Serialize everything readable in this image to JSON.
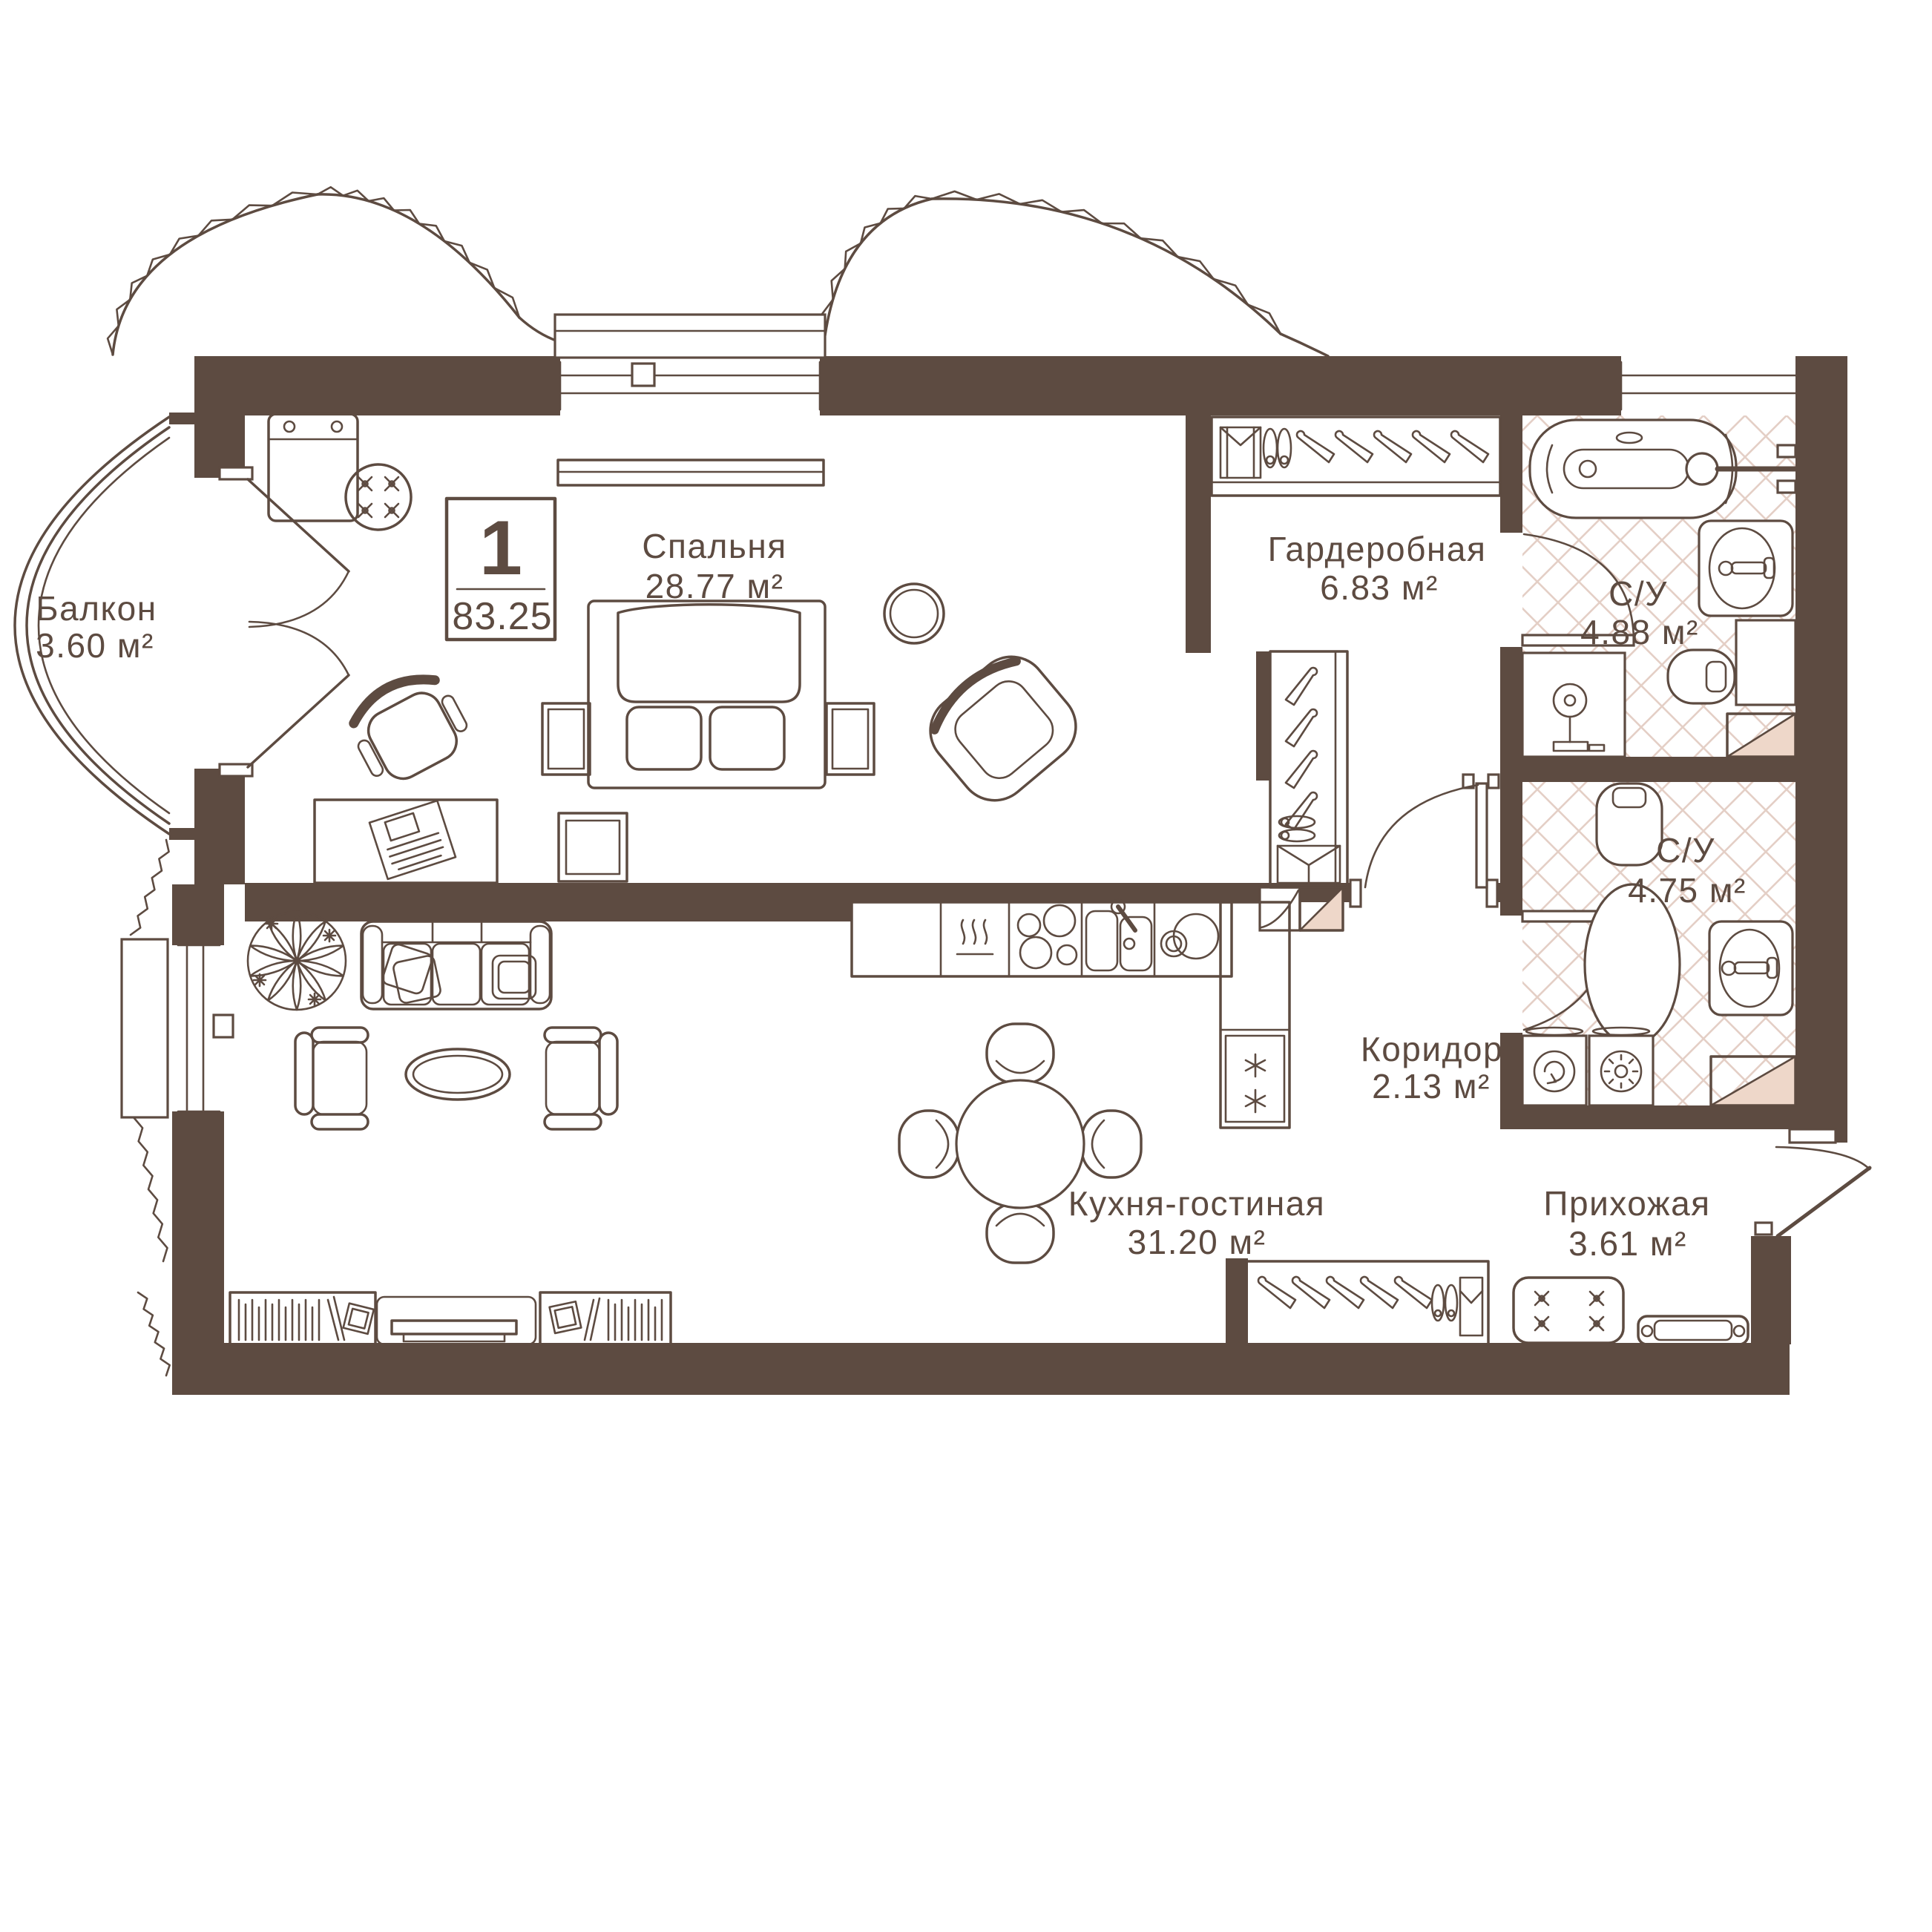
{
  "unit": {
    "rooms_count": "1",
    "total_area": "83.25"
  },
  "rooms": {
    "balcony": {
      "name": "Балкон",
      "area": "3.60 м²"
    },
    "bedroom": {
      "name": "Спальня",
      "area": "28.77 м²"
    },
    "wardrobe": {
      "name": "Гардеробная",
      "area": "6.83 м²"
    },
    "bathroom_1": {
      "name": "С/У",
      "area": "4.88 м²"
    },
    "bathroom_2": {
      "name": "С/У",
      "area": "4.75 м²"
    },
    "corridor": {
      "name": "Коридор",
      "area": "2.13 м²"
    },
    "kitchen_living": {
      "name": "Кухня-гостиная",
      "area": "31.20 м²"
    },
    "hallway": {
      "name": "Прихожая",
      "area": "3.61 м²"
    }
  },
  "colors": {
    "wall": "#5d4b41",
    "line": "#5d4b41",
    "tile": "#e4cfc6",
    "accent": "#eed7c9"
  }
}
